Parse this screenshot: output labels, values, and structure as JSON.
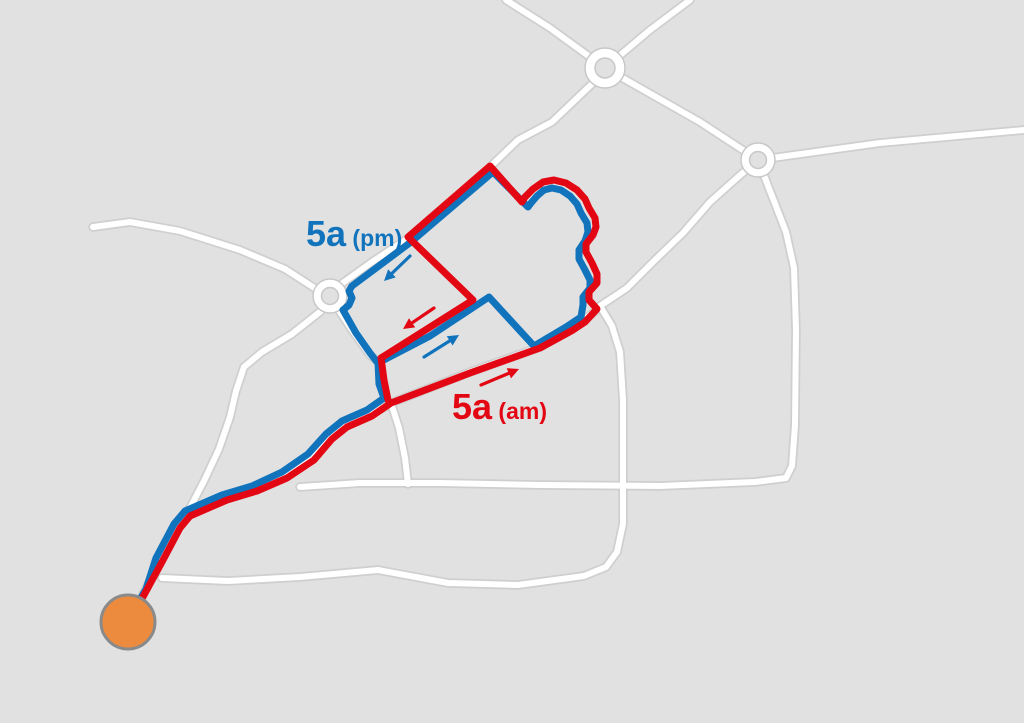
{
  "canvas": {
    "width": 1024,
    "height": 723
  },
  "colors": {
    "background": "#e1e1e2",
    "road_fill": "#ffffff",
    "road_casing": "#cbcbcb",
    "route_am": "#e30613",
    "route_pm": "#1173bc",
    "terminus_fill": "#ec8a3e",
    "terminus_border": "#8a8a8a",
    "roundabout_fill": "#ffffff",
    "roundabout_casing": "#c8c8c8"
  },
  "labels": [
    {
      "id": "label-5a-pm",
      "main": "5a",
      "sub": "(pm)",
      "color": "#1173bc",
      "x": 306,
      "y": 246,
      "main_size": 36,
      "sub_size": 23
    },
    {
      "id": "label-5a-am",
      "main": "5a",
      "sub": "(am)",
      "color": "#e30613",
      "x": 452,
      "y": 419,
      "main_size": 36,
      "sub_size": 23
    }
  ],
  "roads": [
    {
      "id": "road-top-northwest",
      "points": [
        [
          506,
          0
        ],
        [
          550,
          28
        ],
        [
          605,
          68
        ]
      ]
    },
    {
      "id": "road-top-northeast",
      "points": [
        [
          605,
          68
        ],
        [
          650,
          30
        ],
        [
          690,
          0
        ]
      ]
    },
    {
      "id": "road-roundabout-connector",
      "points": [
        [
          605,
          68
        ],
        [
          700,
          122
        ],
        [
          758,
          160
        ]
      ]
    },
    {
      "id": "road-east",
      "points": [
        [
          758,
          160
        ],
        [
          880,
          143
        ],
        [
          1024,
          130
        ]
      ]
    },
    {
      "id": "road-right-south",
      "points": [
        [
          758,
          160
        ],
        [
          772,
          196
        ],
        [
          786,
          232
        ],
        [
          794,
          268
        ],
        [
          796,
          330
        ],
        [
          795,
          425
        ],
        [
          792,
          466
        ],
        [
          786,
          478
        ],
        [
          755,
          482
        ],
        [
          660,
          486
        ],
        [
          540,
          485
        ],
        [
          440,
          483
        ],
        [
          360,
          483
        ],
        [
          300,
          487
        ]
      ]
    },
    {
      "id": "road-south-loop",
      "points": [
        [
          600,
          306
        ],
        [
          612,
          326
        ],
        [
          620,
          352
        ],
        [
          623,
          400
        ],
        [
          623,
          486
        ],
        [
          623,
          524
        ],
        [
          617,
          552
        ],
        [
          606,
          567
        ],
        [
          584,
          576
        ],
        [
          518,
          585
        ],
        [
          448,
          583
        ],
        [
          378,
          570
        ],
        [
          300,
          577
        ],
        [
          228,
          581
        ],
        [
          162,
          578
        ]
      ]
    },
    {
      "id": "road-right-southwest",
      "points": [
        [
          758,
          160
        ],
        [
          738,
          177
        ],
        [
          710,
          202
        ],
        [
          683,
          233
        ],
        [
          654,
          261
        ],
        [
          627,
          288
        ],
        [
          600,
          306
        ]
      ]
    },
    {
      "id": "road-junction-south",
      "points": [
        [
          391,
          403
        ],
        [
          399,
          428
        ],
        [
          405,
          458
        ],
        [
          408,
          484
        ]
      ]
    },
    {
      "id": "road-west",
      "points": [
        [
          93,
          227
        ],
        [
          130,
          222
        ],
        [
          180,
          231
        ],
        [
          240,
          250
        ],
        [
          285,
          269
        ],
        [
          316,
          289
        ]
      ]
    },
    {
      "id": "road-left-southwest",
      "points": [
        [
          321,
          311
        ],
        [
          292,
          334
        ],
        [
          262,
          352
        ],
        [
          244,
          367
        ],
        [
          236,
          391
        ],
        [
          230,
          417
        ],
        [
          219,
          449
        ],
        [
          204,
          481
        ],
        [
          191,
          506
        ],
        [
          181,
          522
        ]
      ]
    },
    {
      "id": "road-corridor",
      "points": [
        [
          140,
          600
        ],
        [
          158,
          565
        ],
        [
          176,
          528
        ],
        [
          187,
          515
        ],
        [
          224,
          499
        ],
        [
          254,
          490
        ],
        [
          284,
          477
        ],
        [
          310,
          459
        ],
        [
          328,
          439
        ],
        [
          344,
          426
        ],
        [
          369,
          415
        ],
        [
          391,
          403
        ]
      ]
    },
    {
      "id": "road-am-diagonal",
      "points": [
        [
          391,
          403
        ],
        [
          470,
          372
        ],
        [
          540,
          347
        ],
        [
          572,
          329
        ],
        [
          598,
          309
        ]
      ]
    },
    {
      "id": "road-left-northeast",
      "points": [
        [
          333,
          290
        ],
        [
          372,
          262
        ],
        [
          410,
          237
        ]
      ]
    },
    {
      "id": "road-left-southeast",
      "points": [
        [
          334,
          303
        ],
        [
          352,
          330
        ],
        [
          370,
          355
        ],
        [
          380,
          363
        ]
      ]
    },
    {
      "id": "road-top-southwest",
      "points": [
        [
          594,
          82
        ],
        [
          552,
          122
        ],
        [
          518,
          140
        ],
        [
          491,
          166
        ]
      ]
    }
  ],
  "routes": [
    {
      "id": "route-5a-pm",
      "color_key": "route_pm",
      "width": 7,
      "points": [
        [
          138,
          603
        ],
        [
          146,
          589
        ],
        [
          156,
          558
        ],
        [
          174,
          524
        ],
        [
          185,
          511
        ],
        [
          222,
          495
        ],
        [
          252,
          486
        ],
        [
          282,
          472
        ],
        [
          308,
          454
        ],
        [
          326,
          434
        ],
        [
          342,
          421
        ],
        [
          367,
          410
        ],
        [
          384,
          398
        ],
        [
          379,
          384
        ],
        [
          378,
          363
        ],
        [
          430,
          336
        ],
        [
          489,
          297
        ],
        [
          534,
          346
        ],
        [
          566,
          327
        ],
        [
          581,
          317
        ],
        [
          583,
          305
        ],
        [
          583,
          297
        ],
        [
          590,
          288
        ],
        [
          590,
          280
        ],
        [
          585,
          270
        ],
        [
          579,
          259
        ],
        [
          579,
          250
        ],
        [
          585,
          241
        ],
        [
          588,
          232
        ],
        [
          587,
          223
        ],
        [
          581,
          213
        ],
        [
          577,
          204
        ],
        [
          570,
          196
        ],
        [
          561,
          190
        ],
        [
          552,
          188
        ],
        [
          544,
          190
        ],
        [
          537,
          196
        ],
        [
          531,
          203
        ],
        [
          528,
          207
        ],
        [
          493,
          172
        ],
        [
          411,
          242
        ],
        [
          352,
          286
        ],
        [
          349,
          291
        ],
        [
          352,
          298
        ],
        [
          349,
          305
        ],
        [
          343,
          310
        ],
        [
          356,
          333
        ],
        [
          370,
          353
        ],
        [
          377,
          362
        ]
      ]
    },
    {
      "id": "route-5a-am",
      "color_key": "route_am",
      "width": 7,
      "points": [
        [
          136,
          609
        ],
        [
          144,
          595
        ],
        [
          162,
          562
        ],
        [
          180,
          528
        ],
        [
          190,
          516
        ],
        [
          227,
          500
        ],
        [
          257,
          491
        ],
        [
          287,
          478
        ],
        [
          314,
          460
        ],
        [
          332,
          439
        ],
        [
          347,
          427
        ],
        [
          372,
          416
        ],
        [
          391,
          403
        ],
        [
          470,
          373
        ],
        [
          540,
          348
        ],
        [
          573,
          330
        ],
        [
          585,
          322
        ],
        [
          597,
          309
        ],
        [
          589,
          300
        ],
        [
          589,
          292
        ],
        [
          597,
          283
        ],
        [
          597,
          274
        ],
        [
          592,
          263
        ],
        [
          586,
          252
        ],
        [
          586,
          244
        ],
        [
          593,
          235
        ],
        [
          596,
          227
        ],
        [
          595,
          218
        ],
        [
          589,
          208
        ],
        [
          585,
          199
        ],
        [
          577,
          190
        ],
        [
          566,
          183
        ],
        [
          554,
          180
        ],
        [
          543,
          182
        ],
        [
          533,
          189
        ],
        [
          525,
          197
        ],
        [
          522,
          202
        ],
        [
          490,
          166
        ],
        [
          408,
          237
        ],
        [
          473,
          300
        ],
        [
          381,
          358
        ],
        [
          384,
          380
        ],
        [
          388,
          400
        ]
      ]
    }
  ],
  "roundabouts": [
    {
      "id": "roundabout-top",
      "cx": 605,
      "cy": 68,
      "r_outer": 20,
      "r_inner": 10
    },
    {
      "id": "roundabout-right",
      "cx": 758,
      "cy": 160,
      "r_outer": 17,
      "r_inner": 8.5
    },
    {
      "id": "roundabout-left",
      "cx": 330,
      "cy": 296,
      "r_outer": 17,
      "r_inner": 8.5
    }
  ],
  "terminus": {
    "id": "terminus-marker",
    "cx": 128,
    "cy": 622,
    "r": 27
  },
  "arrows": [
    {
      "id": "arrow-pm-upper",
      "color_key": "route_pm",
      "tail": [
        410,
        256
      ],
      "head": [
        384,
        281
      ]
    },
    {
      "id": "arrow-am-middle",
      "color_key": "route_am",
      "tail": [
        434,
        308
      ],
      "head": [
        403,
        329
      ]
    },
    {
      "id": "arrow-pm-middle",
      "color_key": "route_pm",
      "tail": [
        424,
        357
      ],
      "head": [
        459,
        335
      ]
    },
    {
      "id": "arrow-am-lower",
      "color_key": "route_am",
      "tail": [
        481,
        385
      ],
      "head": [
        519,
        369
      ]
    }
  ]
}
